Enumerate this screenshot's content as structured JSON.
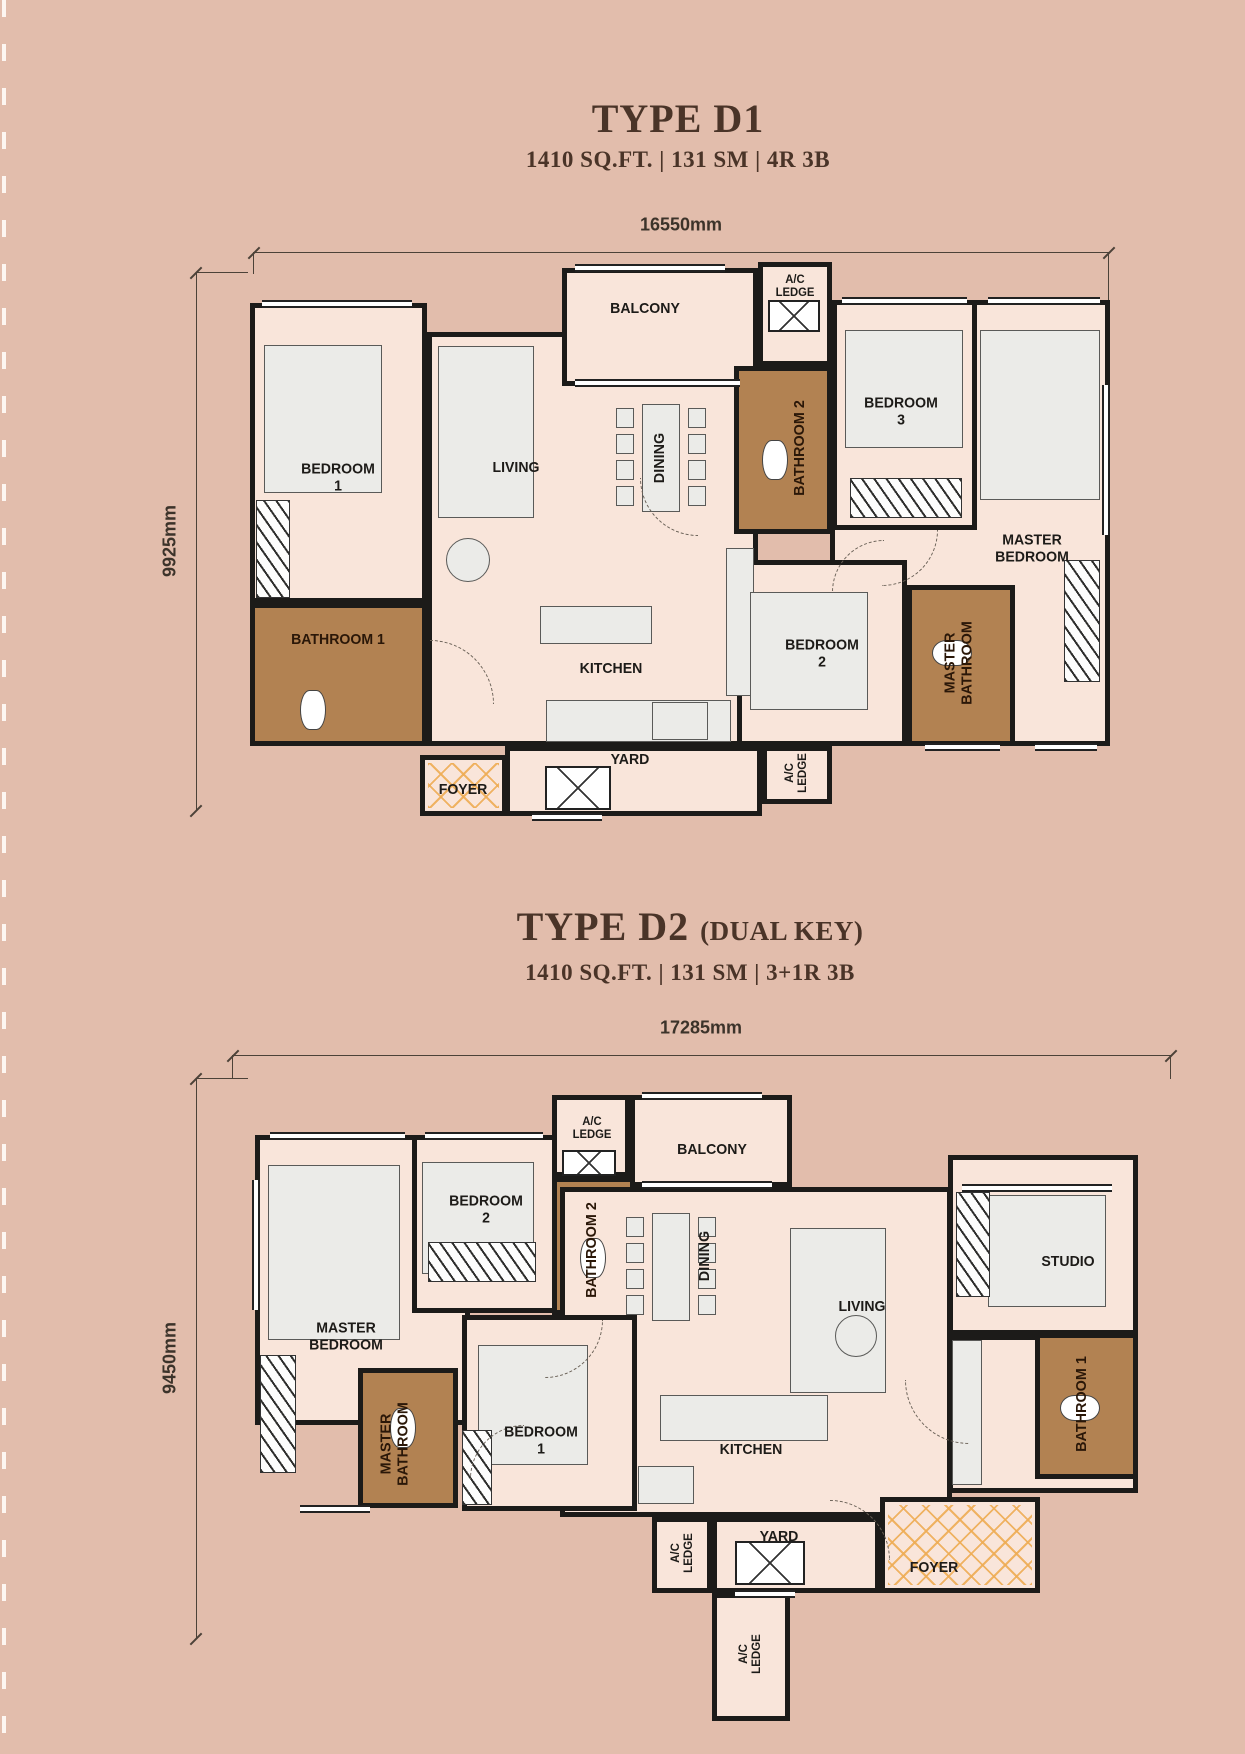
{
  "d1": {
    "title": "TYPE D1",
    "specs": "1410 SQ.FT. | 131 SM | 4R 3B",
    "dim_width": "16550mm",
    "dim_height": "9925mm",
    "rooms": {
      "balcony": "BALCONY",
      "ac_ledge_top": "A/C LEDGE",
      "bedroom1": "BEDROOM 1",
      "bathroom1": "BATHROOM 1",
      "living": "LIVING",
      "dining": "DINING",
      "kitchen": "KITCHEN",
      "bathroom2": "BATHROOM 2",
      "bedroom3": "BEDROOM 3",
      "master_bedroom": "MASTER BEDROOM",
      "bedroom2": "BEDROOM 2",
      "master_bathroom": "MASTER BATHROOM",
      "yard": "YARD",
      "ac_ledge_side": "A/C LEDGE",
      "foyer": "FOYER"
    }
  },
  "d2": {
    "title": "TYPE D2",
    "title_suffix": "(DUAL KEY)",
    "specs": "1410 SQ.FT. | 131 SM | 3+1R 3B",
    "dim_width": "17285mm",
    "dim_height": "9450mm",
    "rooms": {
      "ac_ledge_top": "A/C LEDGE",
      "balcony": "BALCONY",
      "bedroom2": "BEDROOM 2",
      "bathroom2": "BATHROOM 2",
      "dining": "DINING",
      "living": "LIVING",
      "studio": "STUDIO",
      "master_bedroom": "MASTER BEDROOM",
      "master_bathroom": "MASTER BATHROOM",
      "bedroom1": "BEDROOM 1",
      "kitchen": "KITCHEN",
      "bathroom1": "BATHROOM 1",
      "ac_ledge_left": "A/C LEDGE",
      "yard": "YARD",
      "foyer": "FOYER",
      "ac_ledge_bottom": "A/C LEDGE"
    }
  }
}
